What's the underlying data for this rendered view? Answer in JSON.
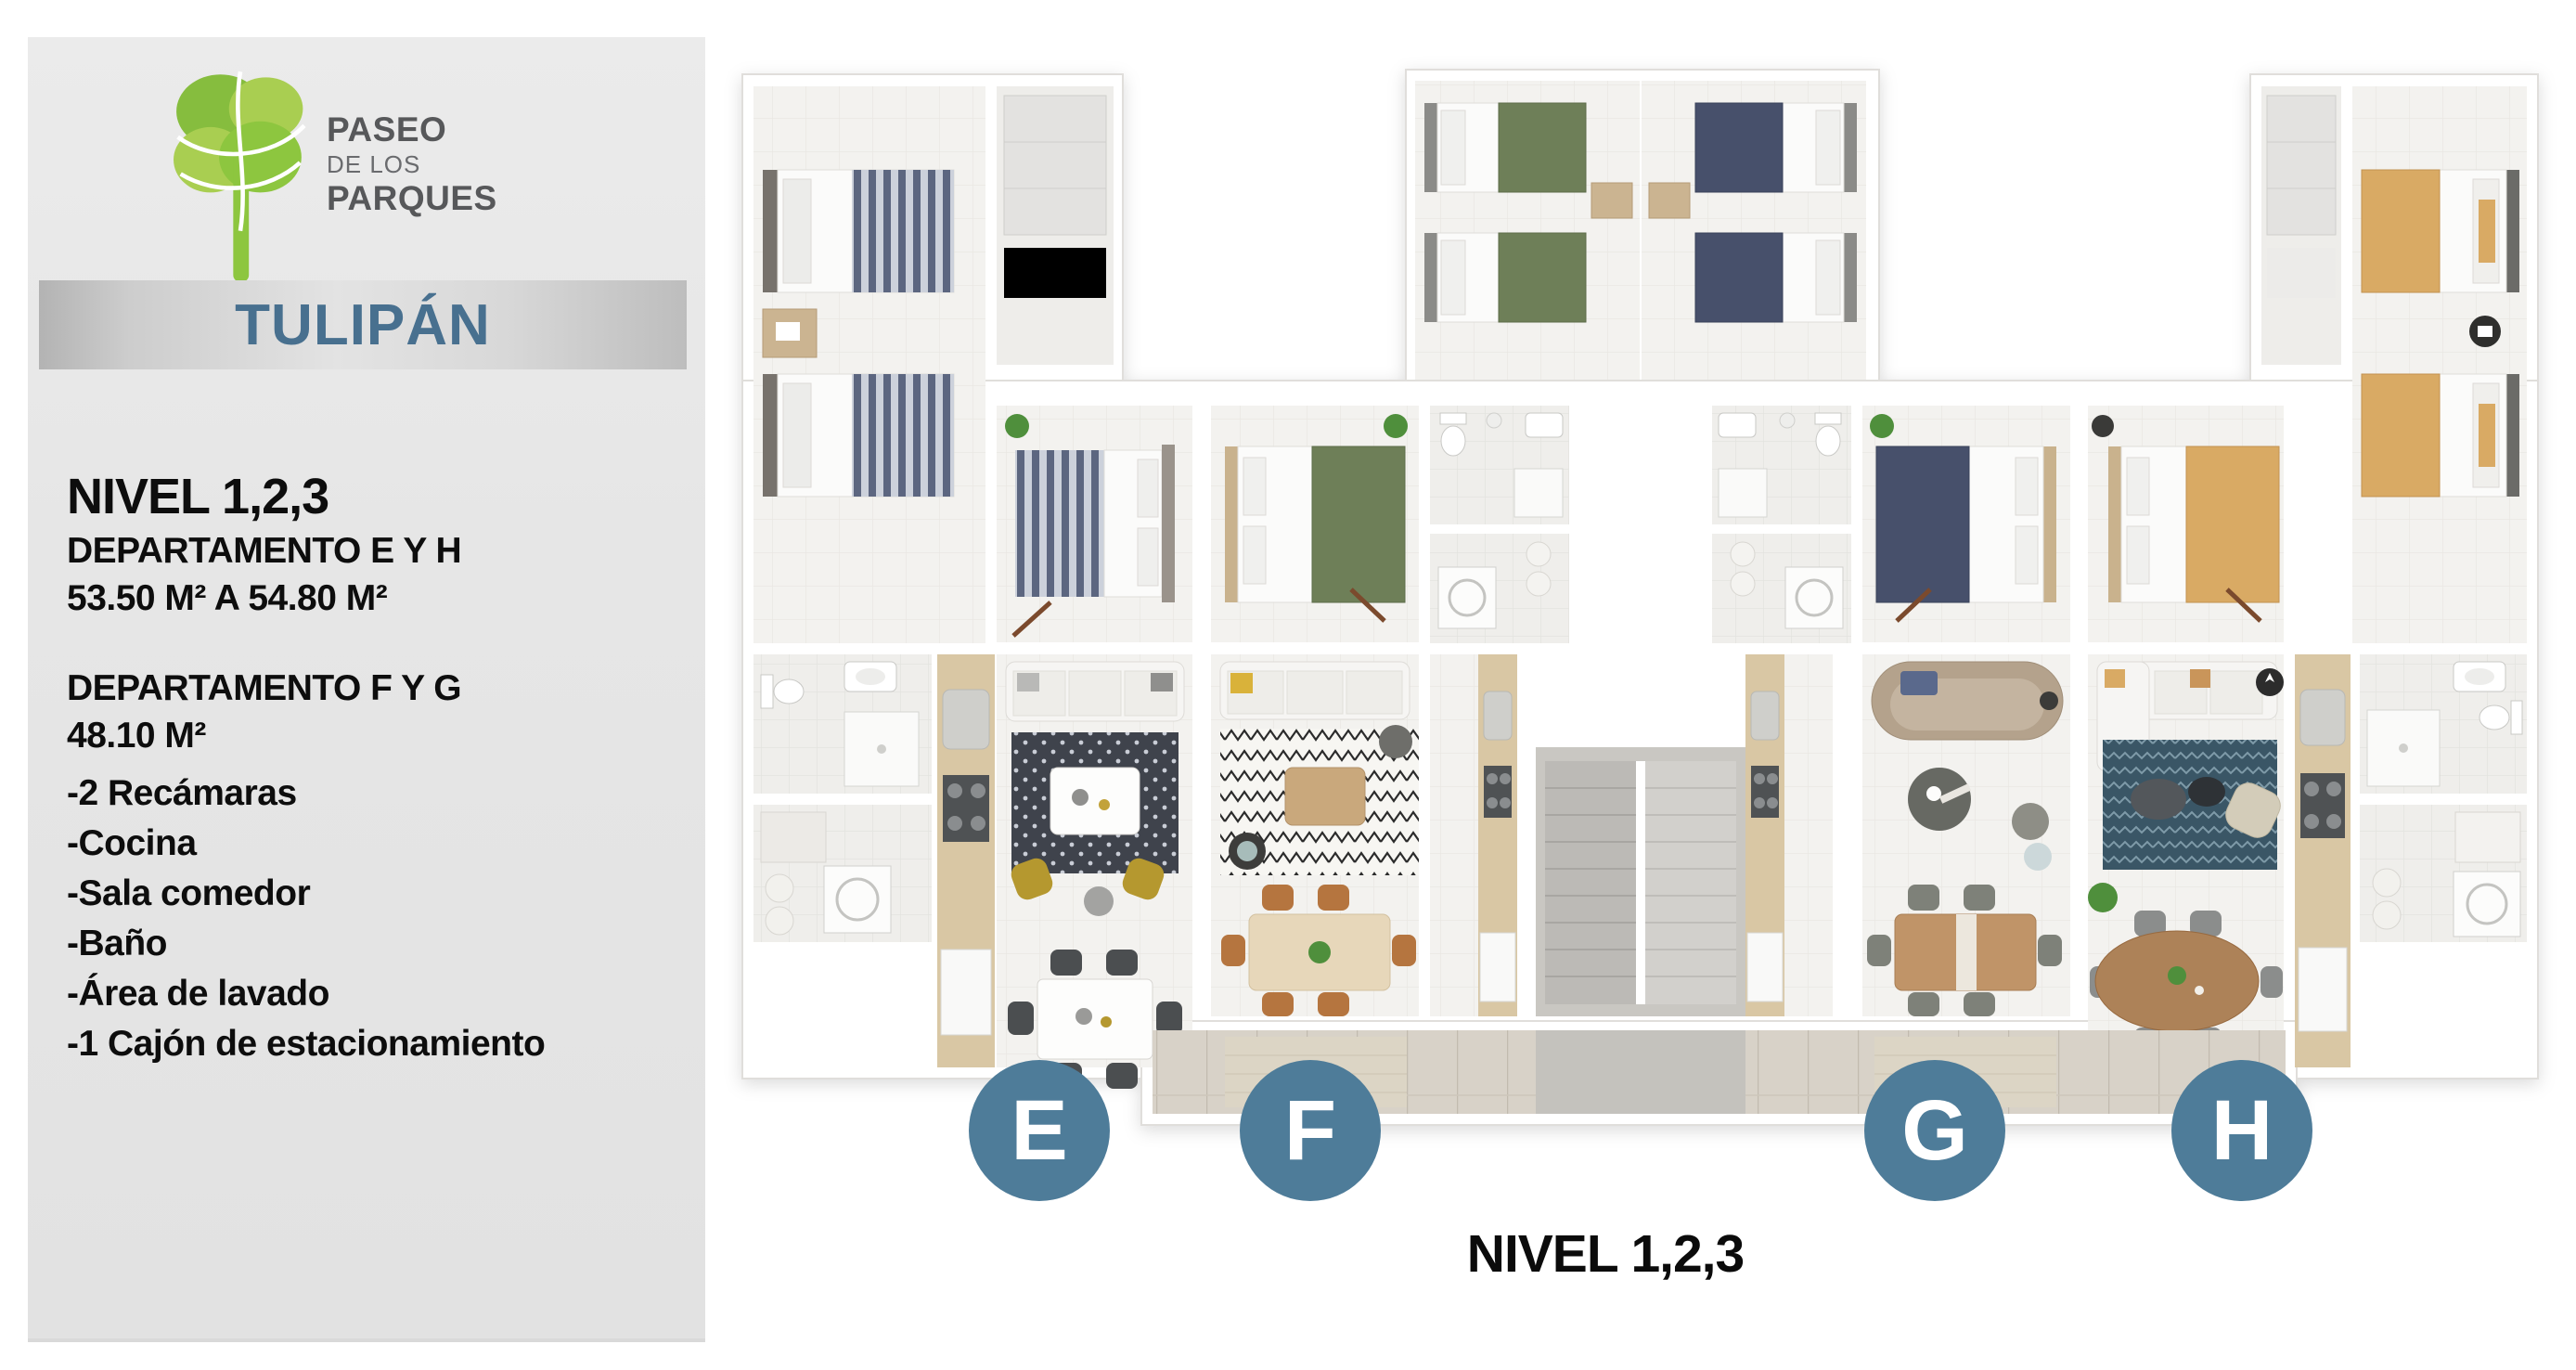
{
  "brand": {
    "name_line1": "PASEO",
    "name_line2": "DE LOS",
    "name_line3": "PARQUES"
  },
  "building": {
    "name": "TULIPÁN"
  },
  "sidebar": {
    "level_title": "NIVEL 1,2,3",
    "specs": [
      {
        "title": "DEPARTAMENTO E Y H",
        "area": "53.50 M² A 54.80 M²"
      },
      {
        "title": "DEPARTAMENTO F Y G",
        "area": "48.10 M²"
      }
    ],
    "features": [
      "-2 Recámaras",
      "-Cocina",
      "-Sala comedor",
      "-Baño",
      "-Área de lavado",
      "-1 Cajón de estacionamiento"
    ]
  },
  "plan": {
    "caption": "NIVEL 1,2,3",
    "units": [
      {
        "label": "E"
      },
      {
        "label": "F"
      },
      {
        "label": "G"
      },
      {
        "label": "H"
      }
    ]
  },
  "colors": {
    "badge_blue": "#4e7c99",
    "title_blue": "#48708f",
    "logo_green_dark": "#86bd3e",
    "logo_green_light": "#a9ce51",
    "brand_gray": "#57585a"
  }
}
